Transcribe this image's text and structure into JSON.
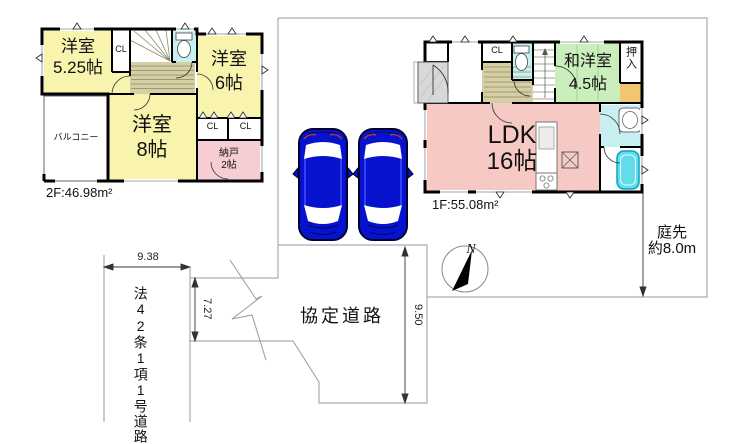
{
  "floor2": {
    "area": "2F:46.98m²",
    "room_5_25": {
      "name": "洋室",
      "size": "5.25帖"
    },
    "room_6": {
      "name": "洋室",
      "size": "6帖"
    },
    "room_8": {
      "name": "洋室",
      "size": "8帖"
    },
    "balcony": "バルコニー",
    "storage": {
      "name": "納戸",
      "size": "2帖"
    },
    "closet": "CL"
  },
  "floor1": {
    "area": "1F:55.08m²",
    "ldk": {
      "name": "LDK",
      "size": "16帖"
    },
    "japanese_room": {
      "name": "和洋室",
      "size": "4.5帖"
    },
    "oshiire": "押入",
    "closet": "CL"
  },
  "site": {
    "north": "N",
    "garden_line1": "庭先",
    "garden_line2": "約8.0m",
    "road_agreement": "協定道路",
    "road_west": "法42条1項1号道路",
    "dim_width": "9.38",
    "dim_left": "7.27",
    "dim_parking": "9.50"
  },
  "colors": {
    "room_yellow": "#f8f4ae",
    "room_pink": "#f6c9c5",
    "room_green": "#cbeebd",
    "wet_cyan": "#c8f0f3",
    "hall_tan": "#d6cfa3",
    "strip_orange": "#f2c670",
    "tub_cyan": "#62dcea",
    "car_blue": "#0712cf",
    "boundary_gray": "#999999"
  }
}
